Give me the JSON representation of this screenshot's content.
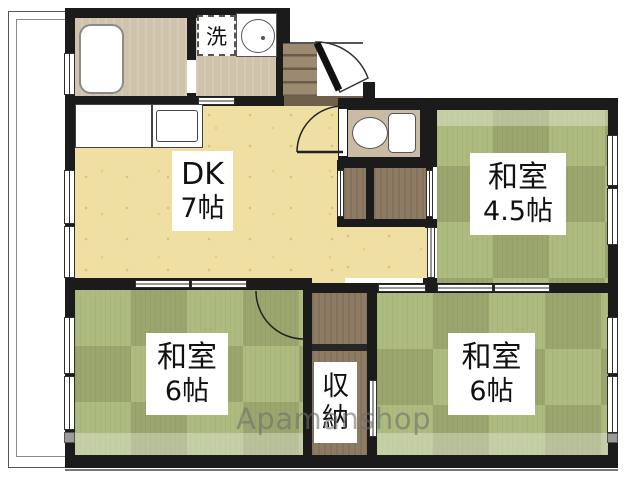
{
  "rooms": {
    "dk": {
      "line1": "DK",
      "line2": "7帖"
    },
    "washitsu_4_5": {
      "line1": "和室",
      "line2": "4.5帖"
    },
    "washitsu_6_left": {
      "line1": "和室",
      "line2": "6帖"
    },
    "washitsu_6_right": {
      "line1": "和室",
      "line2": "6帖"
    },
    "storage": {
      "char1": "収",
      "char2": "納"
    },
    "laundry": {
      "label": "洗"
    }
  },
  "watermark": {
    "text": "Apamanshop"
  },
  "colors": {
    "wall": "#1b1b1b",
    "tatami": "#a9b778",
    "wood": "#f0dfa2",
    "service": "#cfc3ab",
    "genkan": "#9b8a6f",
    "toilet": "#c9bba4",
    "closet": "#8e7b63",
    "label_bg": "#ffffff",
    "watermark_gray": "#6e6e6e"
  }
}
